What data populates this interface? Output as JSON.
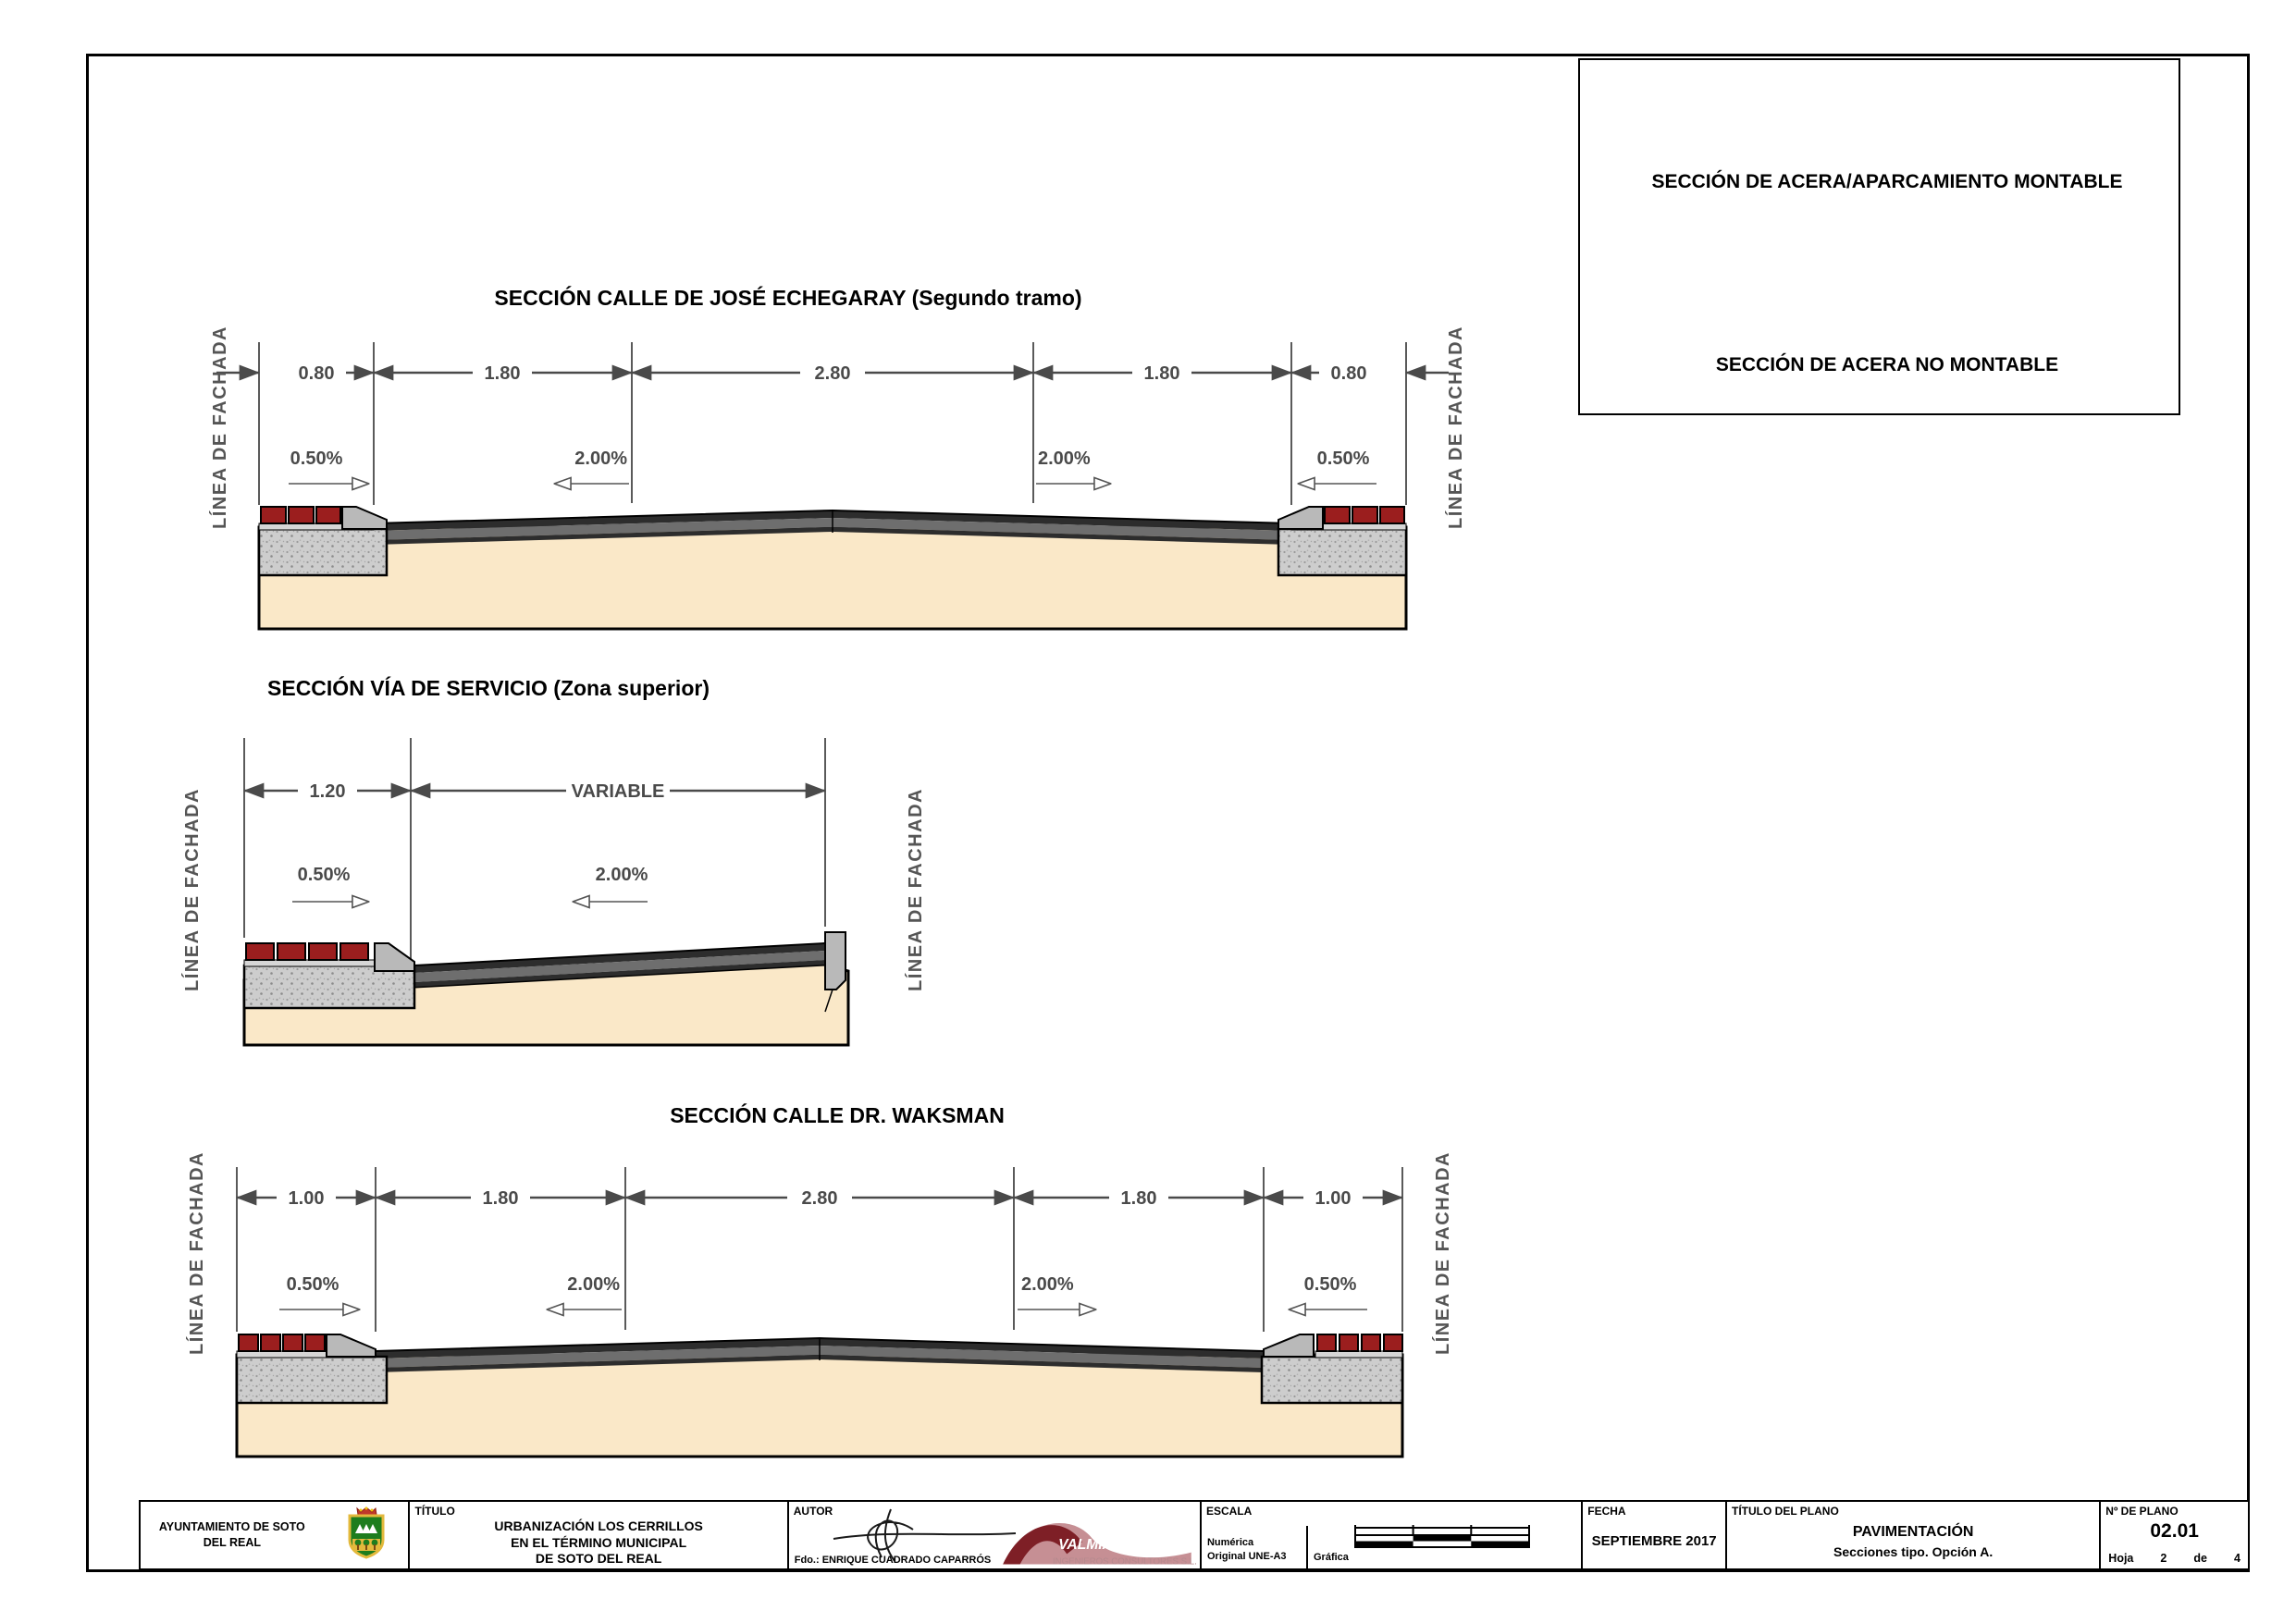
{
  "legend": {
    "montable": "SECCIÓN DE ACERA/APARCAMIENTO MONTABLE",
    "no_montable": "SECCIÓN DE ACERA NO MONTABLE"
  },
  "facade_label": "LÍNEA DE FACHADA",
  "sections": {
    "echegaray": {
      "title": "SECCIÓN CALLE DE JOSÉ ECHEGARAY (Segundo tramo)",
      "dims": [
        "0.80",
        "1.80",
        "2.80",
        "1.80",
        "0.80"
      ],
      "slopes": [
        "0.50%",
        "2.00%",
        "2.00%",
        "0.50%"
      ]
    },
    "servicio": {
      "title": "SECCIÓN VÍA DE SERVICIO (Zona superior)",
      "dims": [
        "1.20",
        "VARIABLE"
      ],
      "slopes": [
        "0.50%",
        "2.00%"
      ]
    },
    "waksman": {
      "title": "SECCIÓN CALLE DR. WAKSMAN",
      "dims": [
        "1.00",
        "1.80",
        "2.80",
        "1.80",
        "1.00"
      ],
      "slopes": [
        "0.50%",
        "2.00%",
        "2.00%",
        "0.50%"
      ]
    }
  },
  "titleblock": {
    "municipality_line1": "AYUNTAMIENTO DE SOTO",
    "municipality_line2": "DEL REAL",
    "titulo_label": "TÍTULO",
    "titulo_line1": "URBANIZACIÓN LOS CERRILLOS",
    "titulo_line2": "EN EL TÉRMINO MUNICIPAL",
    "titulo_line3": "DE SOTO DEL REAL",
    "autor_label": "AUTOR",
    "autor_firma": "Fdo.: ENRIQUE CUADRADO CAPARRÓS",
    "valmia_name": "VALMIA",
    "valmia_sub": "INGENIEROS CONSULTORES S.L.",
    "escala_label": "ESCALA",
    "escala_numerica": "Numérica",
    "escala_original": "Original UNE-A3",
    "escala_grafica": "Gráfica",
    "fecha_label": "FECHA",
    "fecha_value": "SEPTIEMBRE 2017",
    "plano_label": "TÍTULO DEL PLANO",
    "plano_line1": "PAVIMENTACIÓN",
    "plano_line2": "Secciones tipo. Opción A.",
    "num_label": "Nº DE PLANO",
    "num_value": "02.01",
    "hoja_label": "Hoja",
    "hoja_num": "2",
    "hoja_de": "de",
    "hoja_total": "4"
  },
  "colors": {
    "paver_red": "#9b1e1e",
    "paver_yellow": "#efc23b",
    "concrete": "#cdcdcd",
    "curb_gray": "#b9b9b9",
    "asphalt_dark": "#2d2d2d",
    "asphalt_gray": "#6e6e6e",
    "subgrade_tan": "#fae8c8",
    "dim_gray": "#4a4a4a"
  }
}
